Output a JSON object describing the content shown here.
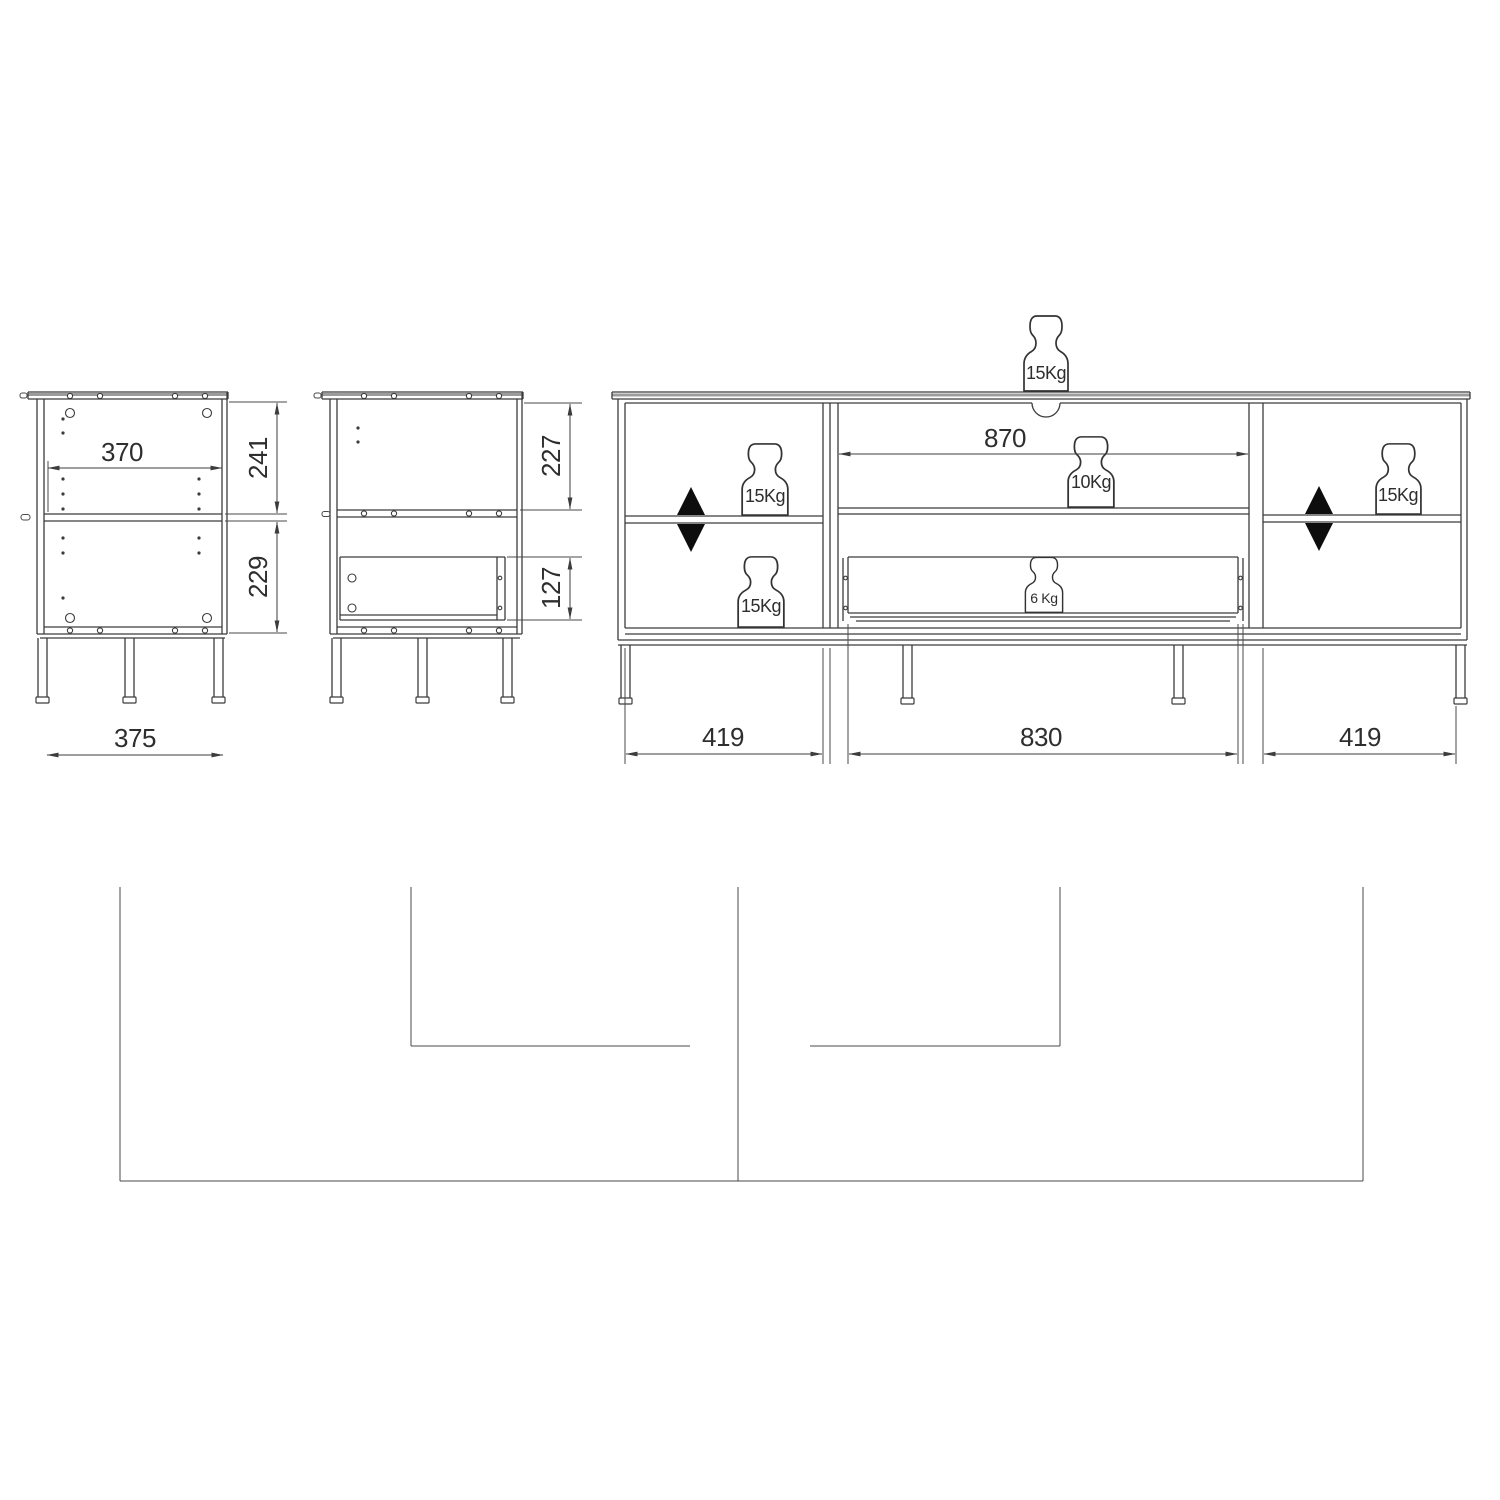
{
  "page": {
    "background": "#ffffff",
    "line_color": "#3c3c3c",
    "description": "furniture technical dimension drawing"
  },
  "views": {
    "side_view_left": {
      "name": "side-view-with-shelf",
      "dims": {
        "inner_width": "370",
        "upper_section_height": "241",
        "lower_section_height": "229",
        "base_width": "375"
      }
    },
    "side_view_middle": {
      "name": "side-view-with-drawer",
      "dims": {
        "upper_section_height": "227",
        "drawer_height": "127"
      }
    },
    "front_view": {
      "name": "front-view-with-load-ratings",
      "dims": {
        "middle_clear_width": "870",
        "left_section_width": "419",
        "middle_section_width": "830",
        "right_section_width": "419"
      },
      "loads": {
        "top_panel": "15Kg",
        "left_shelf": "15Kg",
        "left_bottom": "15Kg",
        "middle_shelf": "10Kg",
        "drawer": "6 Kg",
        "right_shelf": "15Kg"
      }
    }
  }
}
